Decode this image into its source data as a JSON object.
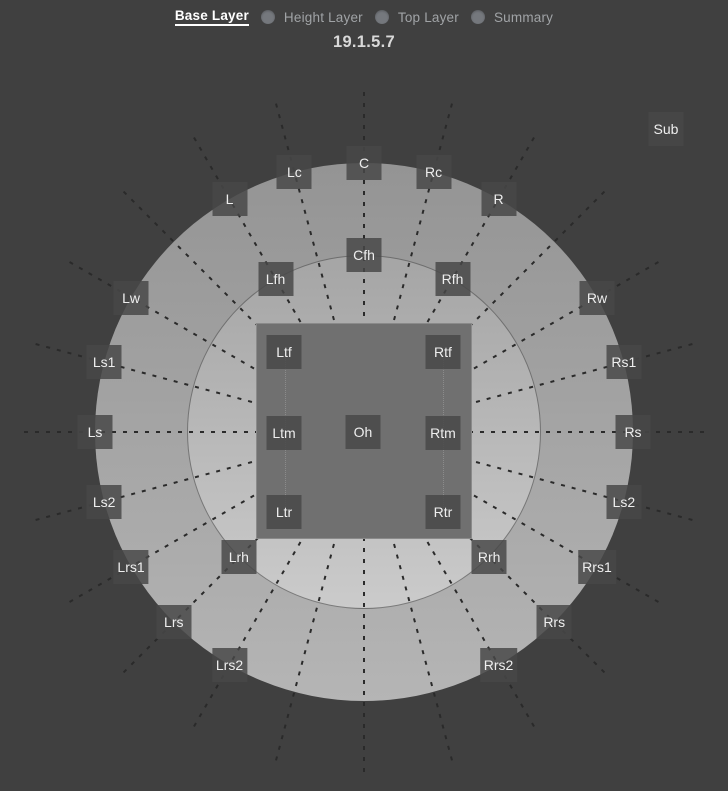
{
  "header": {
    "tabs": [
      {
        "label": "Base Layer",
        "active": true
      },
      {
        "label": "Height Layer",
        "active": false
      },
      {
        "label": "Top Layer",
        "active": false
      },
      {
        "label": "Summary",
        "active": false
      }
    ],
    "config_label": "19.1.5.7"
  },
  "colors": {
    "background": "#404040",
    "outer_ring_top": "#949494",
    "outer_ring_bottom": "#b5b5b5",
    "inner_circle_top": "#a5a5a5",
    "inner_circle_bottom": "#cbcbcb",
    "top_square": "#707070",
    "speaker_box": "rgba(72,72,72,0.84)",
    "speaker_text": "#eeeeee",
    "guide_line": "#2a2a2a",
    "active_tab_text": "#ffffff",
    "inactive_tab_text": "#a0a3a6",
    "tab_dot": "#75787d"
  },
  "diagram": {
    "center": {
      "x": 364,
      "y": 432
    },
    "outer_radius": 269,
    "inner_radius": 177,
    "square_half_size": 108,
    "line_start_radius": 6,
    "line_end_radius": 342,
    "line_angles_deg": [
      0,
      15,
      30,
      45,
      60,
      75,
      90,
      105,
      120,
      135,
      150,
      165,
      180,
      195,
      210,
      225,
      240,
      255,
      270,
      285,
      300,
      315,
      330,
      345
    ],
    "speakers": {
      "base": [
        {
          "id": "c",
          "label": "C",
          "angle": 0
        },
        {
          "id": "rc",
          "label": "Rc",
          "angle": 15
        },
        {
          "id": "r",
          "label": "R",
          "angle": 30
        },
        {
          "id": "rw",
          "label": "Rw",
          "angle": 60
        },
        {
          "id": "rs1",
          "label": "Rs1",
          "angle": 75
        },
        {
          "id": "rs",
          "label": "Rs",
          "angle": 90
        },
        {
          "id": "ls2-right",
          "label": "Ls2",
          "angle": 105
        },
        {
          "id": "rrs1",
          "label": "Rrs1",
          "angle": 120
        },
        {
          "id": "rrs",
          "label": "Rrs",
          "angle": 135
        },
        {
          "id": "rrs2",
          "label": "Rrs2",
          "angle": 150
        },
        {
          "id": "lrs2",
          "label": "Lrs2",
          "angle": 210
        },
        {
          "id": "lrs",
          "label": "Lrs",
          "angle": 225
        },
        {
          "id": "lrs1",
          "label": "Lrs1",
          "angle": 240
        },
        {
          "id": "ls2-left",
          "label": "Ls2",
          "angle": 255
        },
        {
          "id": "ls",
          "label": "Ls",
          "angle": 270
        },
        {
          "id": "ls1",
          "label": "Ls1",
          "angle": 285
        },
        {
          "id": "lw",
          "label": "Lw",
          "angle": 300
        },
        {
          "id": "l",
          "label": "L",
          "angle": 330
        },
        {
          "id": "lc",
          "label": "Lc",
          "angle": 345
        }
      ],
      "height": [
        {
          "id": "cfh",
          "label": "Cfh",
          "angle": 0
        },
        {
          "id": "rfh",
          "label": "Rfh",
          "angle": 30
        },
        {
          "id": "rrh",
          "label": "Rrh",
          "angle": 135
        },
        {
          "id": "lrh",
          "label": "Lrh",
          "angle": 225
        },
        {
          "id": "lfh",
          "label": "Lfh",
          "angle": 330
        }
      ],
      "top": [
        {
          "id": "ltf",
          "label": "Ltf",
          "dx": -80,
          "dy": -80
        },
        {
          "id": "rtf",
          "label": "Rtf",
          "dx": 79,
          "dy": -80
        },
        {
          "id": "ltm",
          "label": "Ltm",
          "dx": -80,
          "dy": 1
        },
        {
          "id": "oh",
          "label": "Oh",
          "dx": -1,
          "dy": 0
        },
        {
          "id": "rtm",
          "label": "Rtm",
          "dx": 79,
          "dy": 1
        },
        {
          "id": "ltr",
          "label": "Ltr",
          "dx": -80,
          "dy": 80
        },
        {
          "id": "rtr",
          "label": "Rtr",
          "dx": 79,
          "dy": 80
        }
      ],
      "sub": {
        "id": "sub",
        "label": "Sub",
        "x": 666,
        "y": 129
      }
    }
  }
}
